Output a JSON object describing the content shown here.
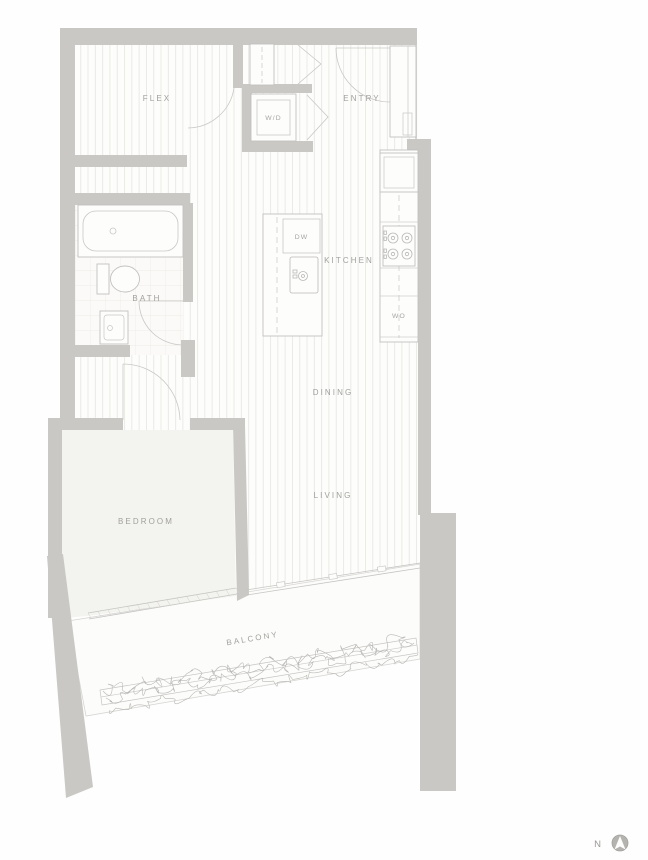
{
  "floorplan": {
    "watermark": "VANS",
    "rooms": {
      "flex": "FLEX",
      "entry": "ENTRY",
      "kitchen": "KITCHEN",
      "bath": "BATH",
      "dining": "DINING",
      "living": "LIVING",
      "bedroom": "BEDROOM",
      "balcony": "BALCONY"
    },
    "appliances": {
      "washer_dryer": "W/D",
      "dishwasher": "DW",
      "wall_oven": "WO"
    },
    "compass": {
      "north_label": "N"
    },
    "colors": {
      "wall": "#c9c8c5",
      "floor_line": "#e5e5e2",
      "label": "#a1a09d",
      "plant_line": "#b8b7b4"
    }
  }
}
